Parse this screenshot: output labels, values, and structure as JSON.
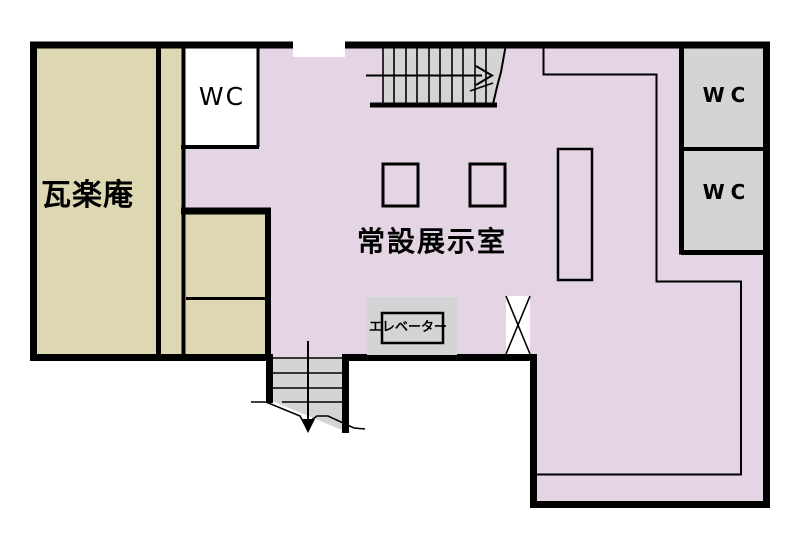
{
  "floorplan": {
    "type": "museum-floor-guide",
    "rooms": {
      "garakuan": "瓦楽庵",
      "exhibition": "常設展示室",
      "wc_left": "WC",
      "wc_right_top": "WC",
      "wc_right_bottom": "WC",
      "elevator": "エレベーター"
    },
    "colors": {
      "room_beige": "#DDD8B1",
      "room_purple": "#E5D5E4",
      "room_gray": "#D4D4D6",
      "wall": "#000000",
      "bg": "#FFFFFF",
      "label": "#000000"
    }
  }
}
